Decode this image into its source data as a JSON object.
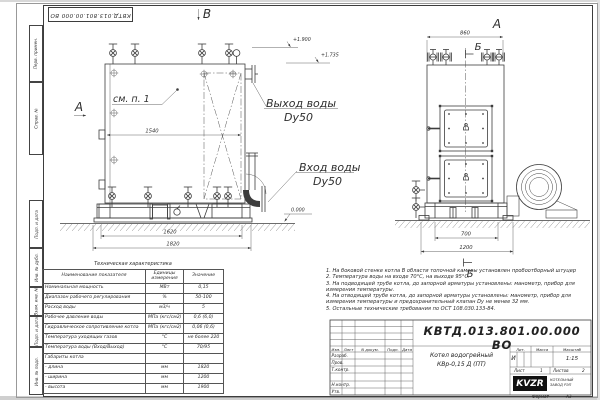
{
  "page": {
    "top_stamp": "КВТД.013.801.00.000 ВО",
    "margin_labels": [
      "Перв. примен.",
      "Справ. №",
      "Подп. и дата",
      "Инв. № дубл.",
      "Взам. инв. №",
      "Подп. и дата",
      "Инв. № подл."
    ]
  },
  "drawing": {
    "view_top_label": "В",
    "side_view_label": "А",
    "front_view_label": "А",
    "section_top_label": "Б",
    "section_bottom_label": "Б",
    "see_note": "см. п. 1",
    "elev_a": "+1.900",
    "elev_b": "+1.735",
    "elev_zero": "0.000",
    "outlet_title": "Выход воды",
    "outlet_dn": "Dy50",
    "inlet_title": "Вход воды",
    "inlet_dn": "Dy50",
    "dim_1540": "1540",
    "dim_1620": "1620",
    "dim_1820": "1820",
    "dim_860": "860",
    "dim_700": "700",
    "dim_1200": "1200"
  },
  "spec_table": {
    "title": "Техническая характеристика",
    "headers": [
      "Наименование показателя",
      "Единицы измерения",
      "Значение"
    ],
    "rows": [
      {
        "name": "Номинальная мощность",
        "unit": "МВт",
        "value": "0,15"
      },
      {
        "name": "Диапазон рабочего регулирования",
        "unit": "%",
        "value": "50-100"
      },
      {
        "name": "Расход воды",
        "unit": "м3/ч",
        "value": "5"
      },
      {
        "name": "Рабочее давление воды",
        "unit": "МПа (кгс/см2)",
        "value": "0,6 (6,0)"
      },
      {
        "name": "Гидравлическое сопротивление котла",
        "unit": "МПа (кгс/см2)",
        "value": "0,06 (0,6)"
      },
      {
        "name": "Температура уходящих газов",
        "unit": "°С",
        "value": "не более 220"
      },
      {
        "name": "Температура воды (Вход/Выход)",
        "unit": "°С",
        "value": "70/95"
      },
      {
        "name": "Габариты котла",
        "unit": "",
        "value": ""
      },
      {
        "name": "- длина",
        "unit": "мм",
        "value": "1820"
      },
      {
        "name": "- ширина",
        "unit": "мм",
        "value": "1200"
      },
      {
        "name": "- высота",
        "unit": "мм",
        "value": "1900"
      }
    ]
  },
  "notes": {
    "lines": [
      "1.  На боковой стенке котла В области топочной камеры установлен пробоотборный штуцер",
      "2.  Температура воды на входе 70°С, на выходе 95°С.",
      "3.  На подводящей трубе котла, до запорной арматуры установлены: манометр, прибор для",
      "измерения температуры.",
      "4.  На отводящей трубе котла, до запорной арматуры установлены: манометр, прибор для",
      "измерения температуры и предохранительный клапан Dу не менее 32 мм.",
      "5.  Остальные технические требования по ОСТ 108.030.133-84."
    ]
  },
  "title_block": {
    "doc_number": "КВТД.013.801.00.000  ВО",
    "product_name_line1": "Котел водогрейный",
    "product_name_line2": "КВр-0,15  Д  (ПТ)",
    "columns": [
      "Изм.",
      "Лист",
      "N докум.",
      "Подп.",
      "Дата"
    ],
    "roles": [
      "Разраб.",
      "Пров.",
      "Т.контр.",
      "Н.контр.",
      "Утв."
    ],
    "lit_label": "Лит.",
    "mass_label": "Масса",
    "scale_label": "Масштаб",
    "lit_value": "И",
    "scale_value": "1:15",
    "sheet_label": "Лист",
    "sheet_value": "1",
    "sheets_label": "Листов",
    "sheets_value": "2",
    "logo_text": "KVZR",
    "logo_caption_line1": "КОТЕЛЬНЫЙ",
    "logo_caption_line2": "ЗАВОД РЭП",
    "format_label": "Формат",
    "format_value": "А3"
  }
}
